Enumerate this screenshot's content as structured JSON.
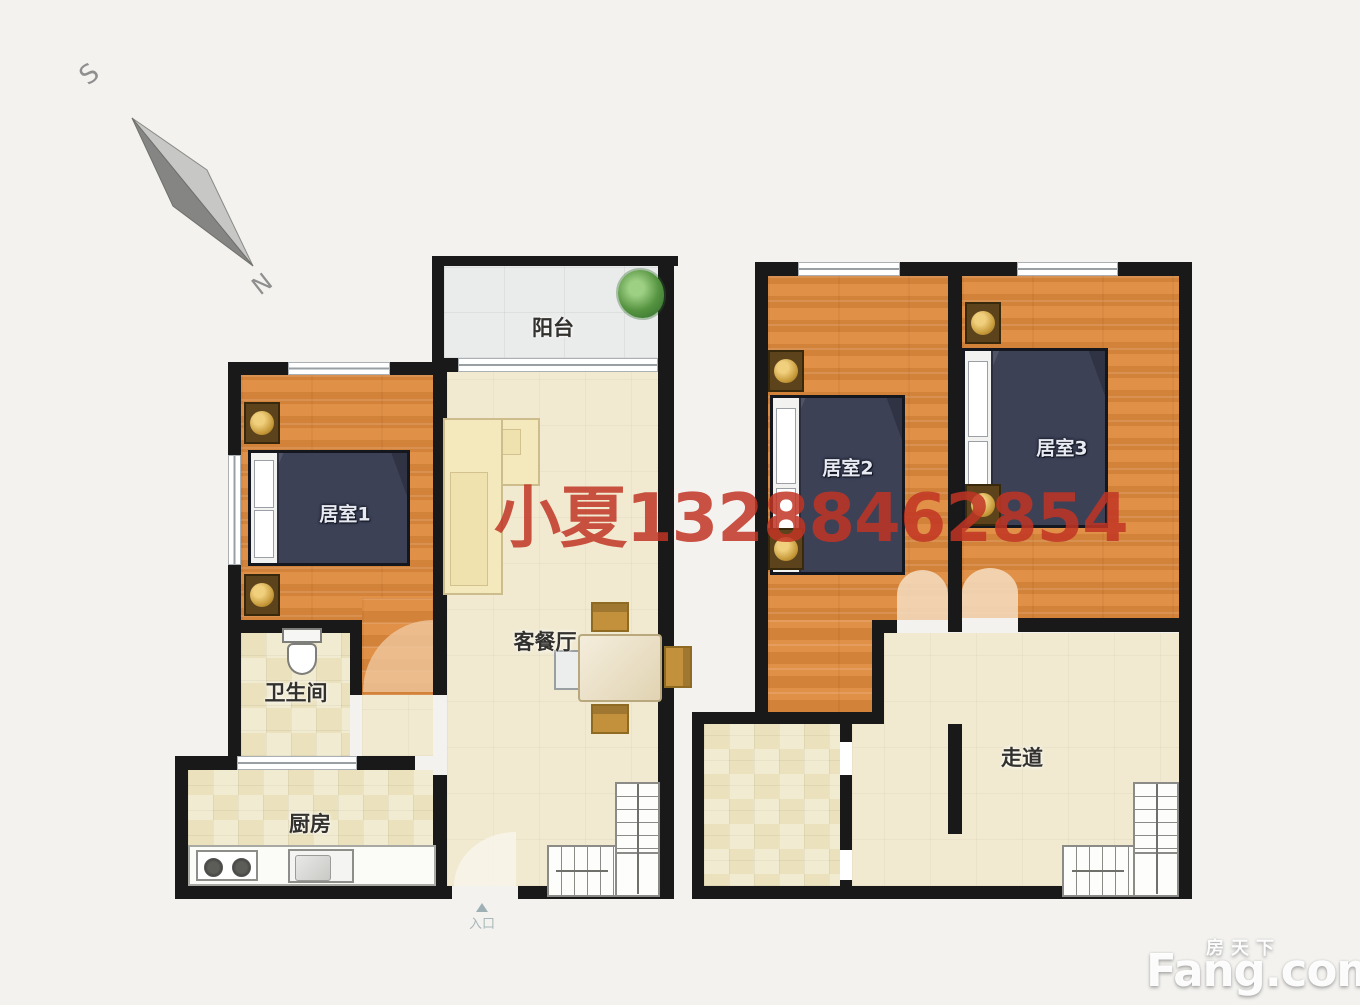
{
  "canvas": {
    "width": 1360,
    "height": 1005,
    "background": "#f3f2ef"
  },
  "compass": {
    "south": "S",
    "north": "N"
  },
  "watermark": {
    "agent_phone": "小夏13288462854",
    "color": "#c13525"
  },
  "brand": {
    "cn": "房天下",
    "en": "Fang.com"
  },
  "rooms": {
    "balcony": "阳台",
    "bedroom1": "居室1",
    "bathroom": "卫生间",
    "kitchen": "厨房",
    "living_dining": "客餐厅",
    "bedroom2": "居室2",
    "bedroom3": "居室3",
    "corridor": "走道",
    "entrance": "入口"
  },
  "colors": {
    "wall": "#191919",
    "wood_floor": "#dd8a3f",
    "beige_floor": "#f1ead1",
    "tile_floor": "#ebe2bd",
    "balcony_floor": "#eaeceb",
    "bed": "#3c4156",
    "accent_gold": "#c79a3a"
  }
}
